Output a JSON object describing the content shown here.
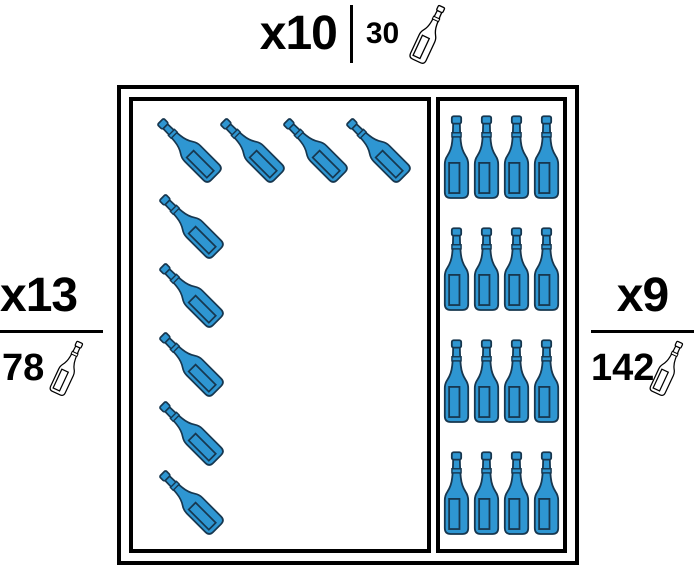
{
  "labels": {
    "top": {
      "multiplier": "x10",
      "count": "30",
      "icon": "wine-bottle-outline"
    },
    "left": {
      "multiplier": "x13",
      "count": "78",
      "icon": "wine-bottle-outline"
    },
    "right": {
      "multiplier": "x9",
      "count": "142",
      "icon": "wine-bottle-outline"
    }
  },
  "cellar": {
    "diagonal_bottles": {
      "top_row_count": 4,
      "left_column_count": 5,
      "total": 9
    },
    "panel_bottles": {
      "rows": 4,
      "columns": 4,
      "total": 16
    },
    "bottle_fill": "#2E96D2",
    "bottle_outline": "#17374F",
    "box_border": "#000000"
  }
}
